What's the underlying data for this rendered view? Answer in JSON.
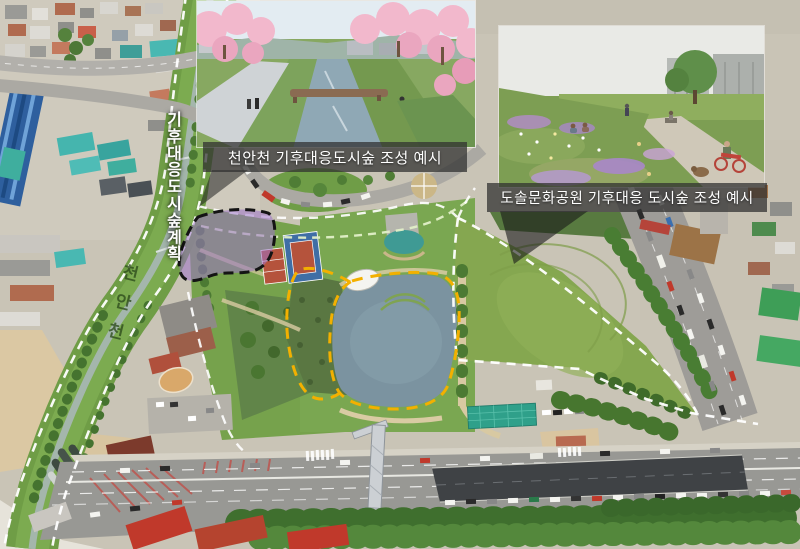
{
  "insets": {
    "cheonancheon": {
      "caption": "천안천 기후대응도시숲 조성 예시"
    },
    "dosol_park": {
      "caption": "도솔문화공원 기후대응 도시숲 조성 예시"
    }
  },
  "map_labels": {
    "corridor_vertical_label": "기후대응도시숲계획",
    "stream_grass_label": "천안천"
  },
  "annotation_colors": {
    "plan_boundary_dash": "#ffffff",
    "pond_boundary_dash": "#f3b000",
    "site_fill": "rgba(156,115,200,0.55)",
    "site_boundary_dash": "#141414",
    "stream_guide_dash": "#e2efc8"
  }
}
